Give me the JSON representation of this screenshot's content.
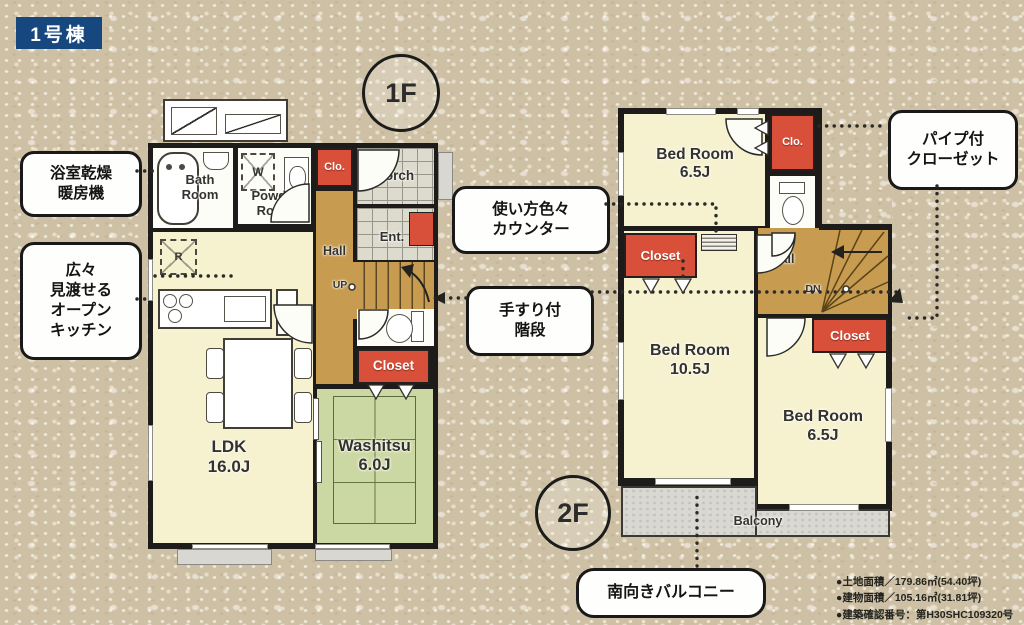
{
  "badge": {
    "label": "1号棟"
  },
  "floors": {
    "f1": "1F",
    "f2": "2F"
  },
  "callouts": {
    "bath_dryer": [
      "浴室乾燥",
      "暖房機"
    ],
    "open_kitchen": [
      "広々",
      "見渡せる",
      "オープン",
      "キッチン"
    ],
    "multi_counter": [
      "使い方色々",
      "カウンター"
    ],
    "handrail_stairs": [
      "手すり付",
      "階段"
    ],
    "pipe_closet": [
      "パイプ付",
      "クローゼット"
    ],
    "south_balcony": "南向きバルコニー"
  },
  "floor1": {
    "bath": [
      "Bath",
      "Room"
    ],
    "powder": [
      "Powder",
      "Room"
    ],
    "clo": "Clo.",
    "porch": "Porch",
    "ent": "Ent.",
    "hall": "Hall",
    "up": "UP",
    "closet": "Closet",
    "ldk": [
      "LDK",
      "16.0J"
    ],
    "washitsu": [
      "Washitsu",
      "6.0J"
    ],
    "washer_mark": "W",
    "fridge_mark": "R"
  },
  "floor2": {
    "bedroom_north": [
      "Bed Room",
      "6.5J"
    ],
    "clo": "Clo.",
    "closet_west": "Closet",
    "closet_east": "Closet",
    "hall": "Hall",
    "dn": "DN",
    "bedroom_main": [
      "Bed Room",
      "10.5J"
    ],
    "bedroom_south": [
      "Bed Room",
      "6.5J"
    ],
    "balcony": "Balcony"
  },
  "legal": [
    "●土地面積／179.86㎡(54.40坪)",
    "●建物面積／105.16㎡(31.81坪)",
    "●建築確認番号：第H30SHC109320号"
  ],
  "colors": {
    "badge_blue": "#17477f",
    "closet_red": "#d8503a",
    "hall_brown": "#c79b50",
    "tatami_green": "#ccd8a4",
    "room_cream": "#f6f1cf",
    "balcony_gray": "#d9d8d3",
    "background_beige": "#cec0a4",
    "wall_black": "#1e1c1a"
  }
}
